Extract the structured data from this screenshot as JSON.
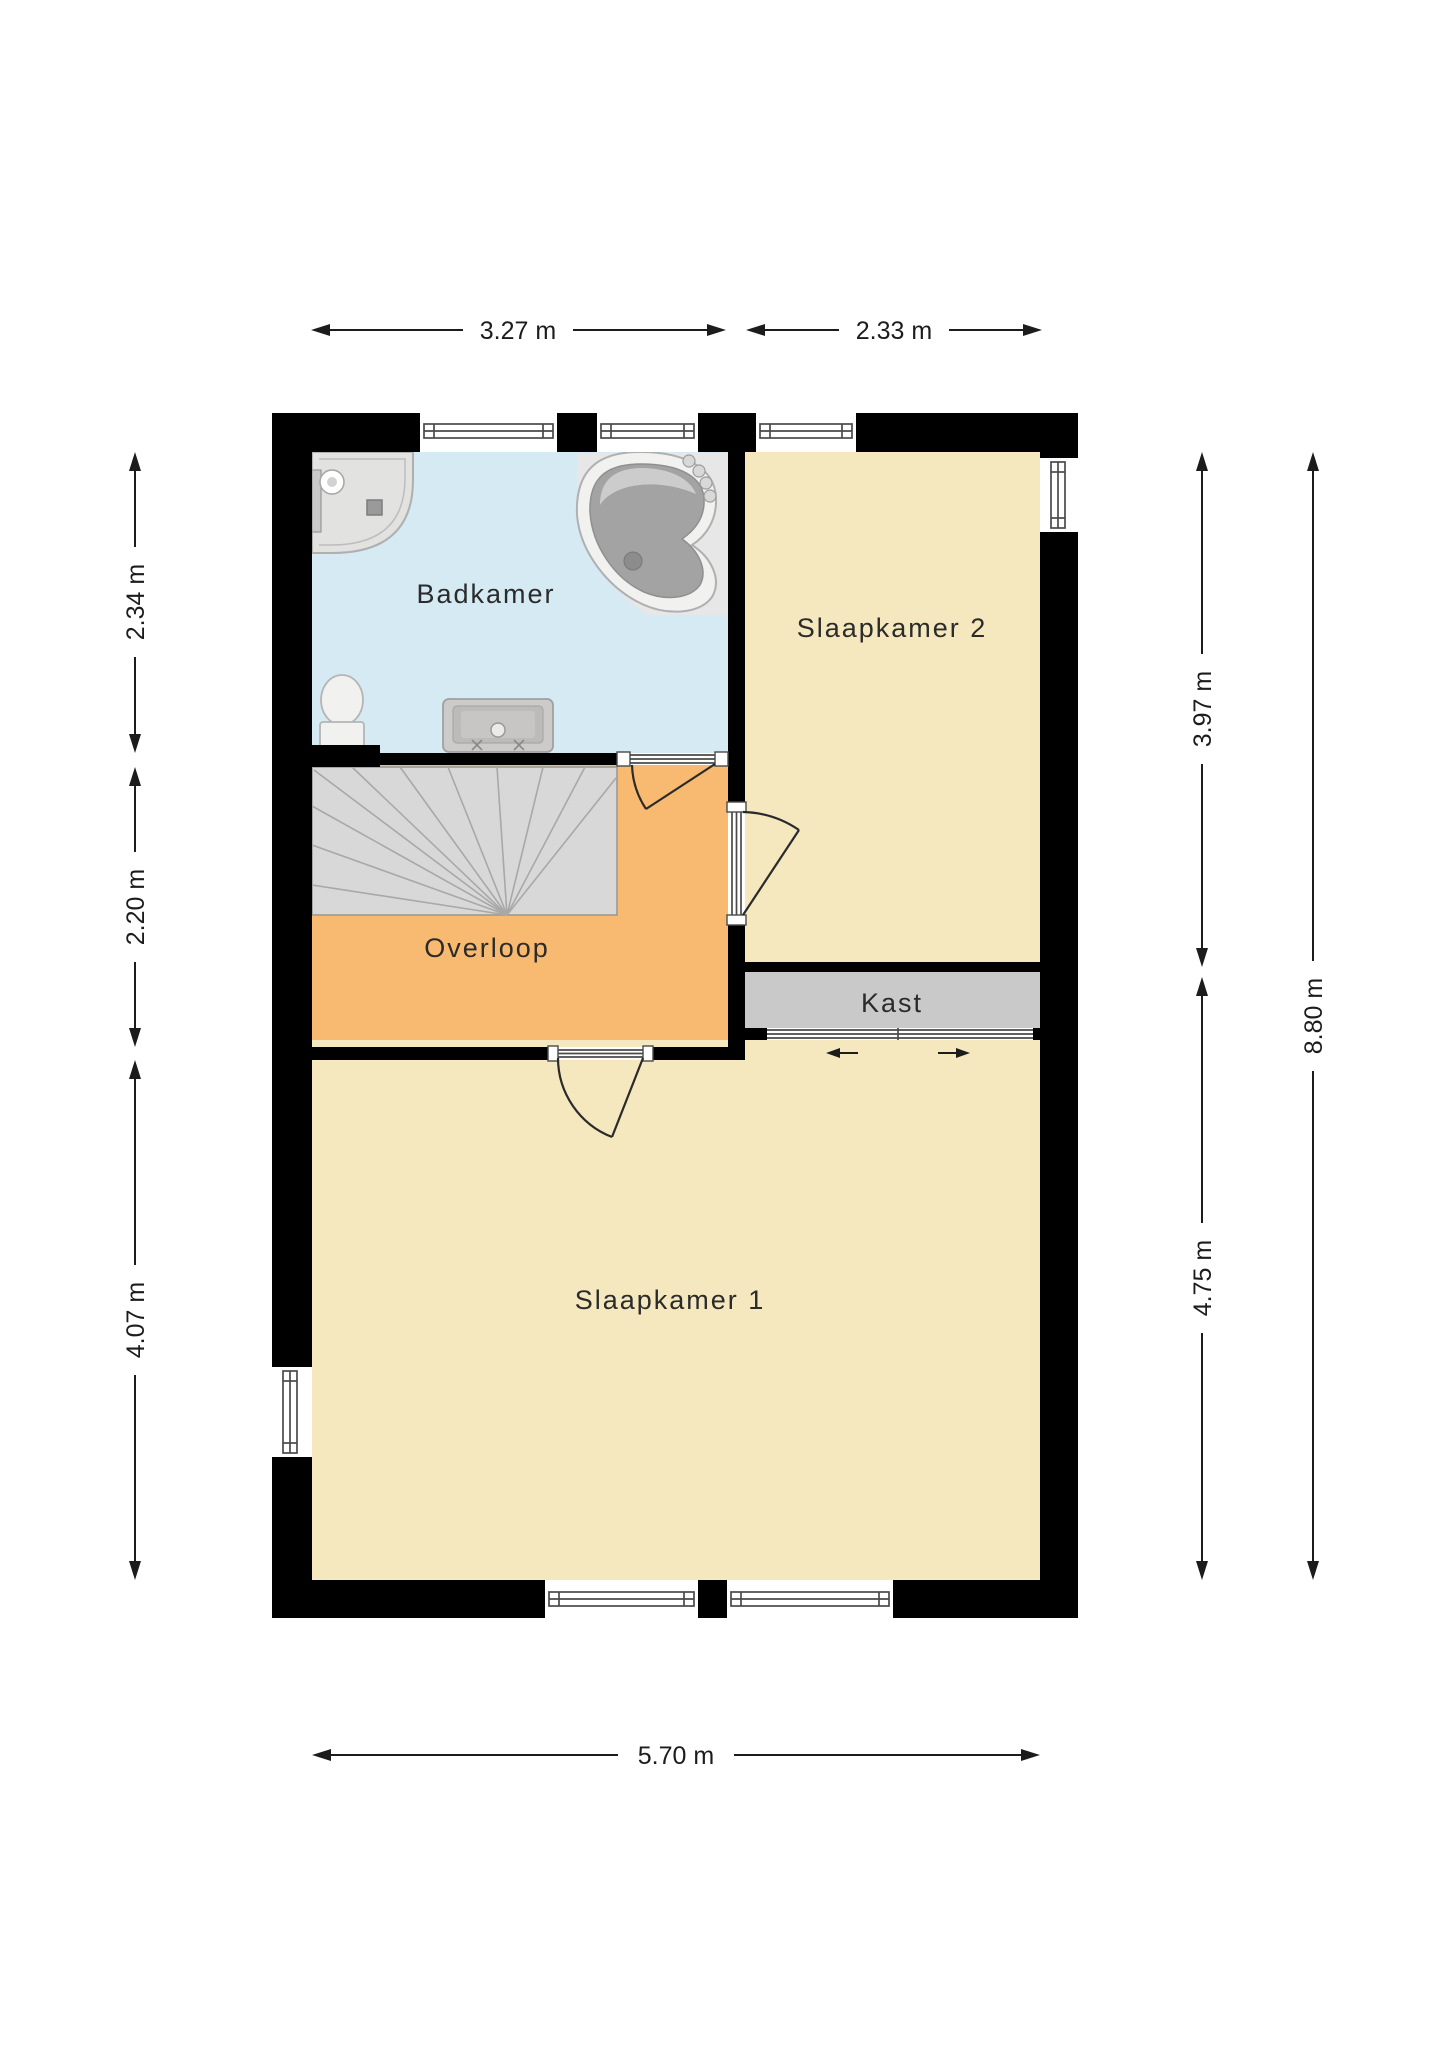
{
  "rooms": {
    "badkamer": {
      "label": "Badkamer"
    },
    "slaapkamer2": {
      "label": "Slaapkamer 2"
    },
    "overloop": {
      "label": "Overloop"
    },
    "kast": {
      "label": "Kast"
    },
    "slaapkamer1": {
      "label": "Slaapkamer 1"
    }
  },
  "dimensions": {
    "top_left": "3.27 m",
    "top_right": "2.33 m",
    "left_top": "2.34 m",
    "left_middle": "2.20 m",
    "left_bottom": "4.07 m",
    "right_top": "3.97 m",
    "right_bottom": "4.75 m",
    "right_total": "8.80 m",
    "bottom": "5.70 m"
  },
  "colors": {
    "wall": "#000000",
    "badkamer_floor": "#d5eaf3",
    "bedroom_floor": "#f5e8be",
    "overloop_floor": "#f8ba70",
    "kast_floor": "#c9c9c9",
    "stairs_floor": "#d8d8d8",
    "fixture_light": "#f1f1f0",
    "tub_basin": "#a3a3a3"
  },
  "fixtures": [
    "corner-shower",
    "bathtub",
    "toilet",
    "sink-vanity",
    "winder-stairs",
    "sliding-closet-doors"
  ]
}
